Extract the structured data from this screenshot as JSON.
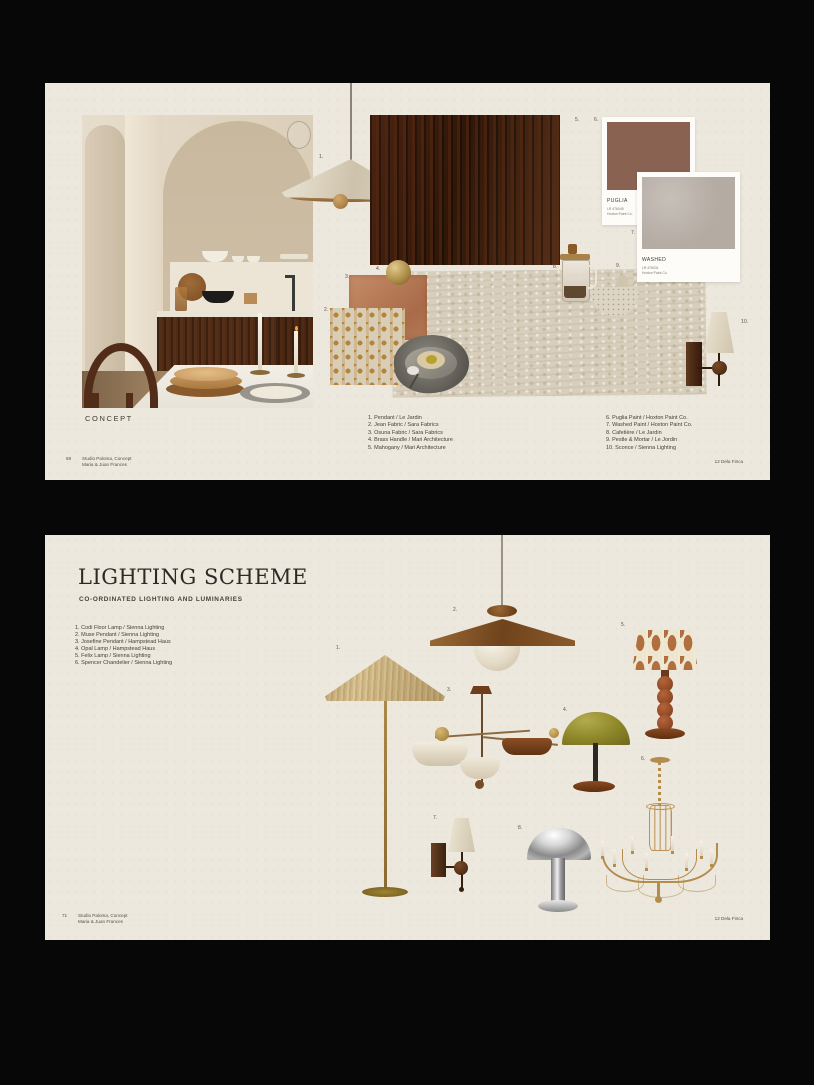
{
  "colors": {
    "canvas_bg": "#070707",
    "page_bg": "#ece8dd",
    "walnut": "#3d2010",
    "travertine": "#d7cebc",
    "terracotta_fabric": "#bb7e5b",
    "damask_gold": "#b5843c",
    "brass": "#b59653",
    "olive": "#8d8628",
    "chrome": "#c6c6c6",
    "text_dark": "#3b3b37"
  },
  "page1": {
    "section_label": "CONCEPT",
    "markers": [
      "1.",
      "2.",
      "3.",
      "4.",
      "5.",
      "6.",
      "7.",
      "8.",
      "9.",
      "10."
    ],
    "paints": [
      {
        "name": "PUGLIA",
        "code": "LR 476045",
        "brand": "Hoxton Paint Co.",
        "hex": "#8a6252"
      },
      {
        "name": "WASHED",
        "code": "LR 476031",
        "brand": "Hoxton Paint Co.",
        "hex": "#b4aba2"
      }
    ],
    "credits_left": [
      "1. Pendant / Le Jardin",
      "2. Jean Fabric / Sara Fabrics",
      "3. Osuna Fabric / Sara Fabrics",
      "4. Brass Handle / Mari Architecture",
      "5. Mahogany / Mari Architecture"
    ],
    "credits_right": [
      "6. Puglia Paint / Hoxton Paint Co.",
      "7. Washed Paint / Hoxton Paint Co.",
      "8. Cafetière / Le Jardin",
      "9. Pestle & Mortar / Le Jordin",
      "10. Sconce / Sienna Lighting"
    ],
    "footer": {
      "page_number": "68",
      "studio_line1": "Studio Paloma, Concept",
      "studio_line2": "Maria & Juan Frances",
      "project": "12 Dela Finca"
    }
  },
  "page2": {
    "title": "LIGHTING SCHEME",
    "subtitle": "CO-ORDINATED LIGHTING AND LUMINARIES",
    "markers": [
      "1.",
      "2.",
      "3.",
      "4.",
      "5.",
      "6.",
      "7.",
      "8."
    ],
    "items": [
      "1. Codi Floor Lamp / Sienna Lighting",
      "2. Muse Pendant / Sienna Lighting",
      "3. Josefine Pendant / Hampstead Haus",
      "4. Opal Lamp / Hampstead Haus",
      "5. Felix Lamp / Sienna Lighting",
      "6. Spencer Chandelier / Sienna Lighting"
    ],
    "footer": {
      "page_number": "71",
      "studio_line1": "Studio Paloma, Concept",
      "studio_line2": "Maria & Juan Frances",
      "project": "12 Dela Finca"
    }
  }
}
